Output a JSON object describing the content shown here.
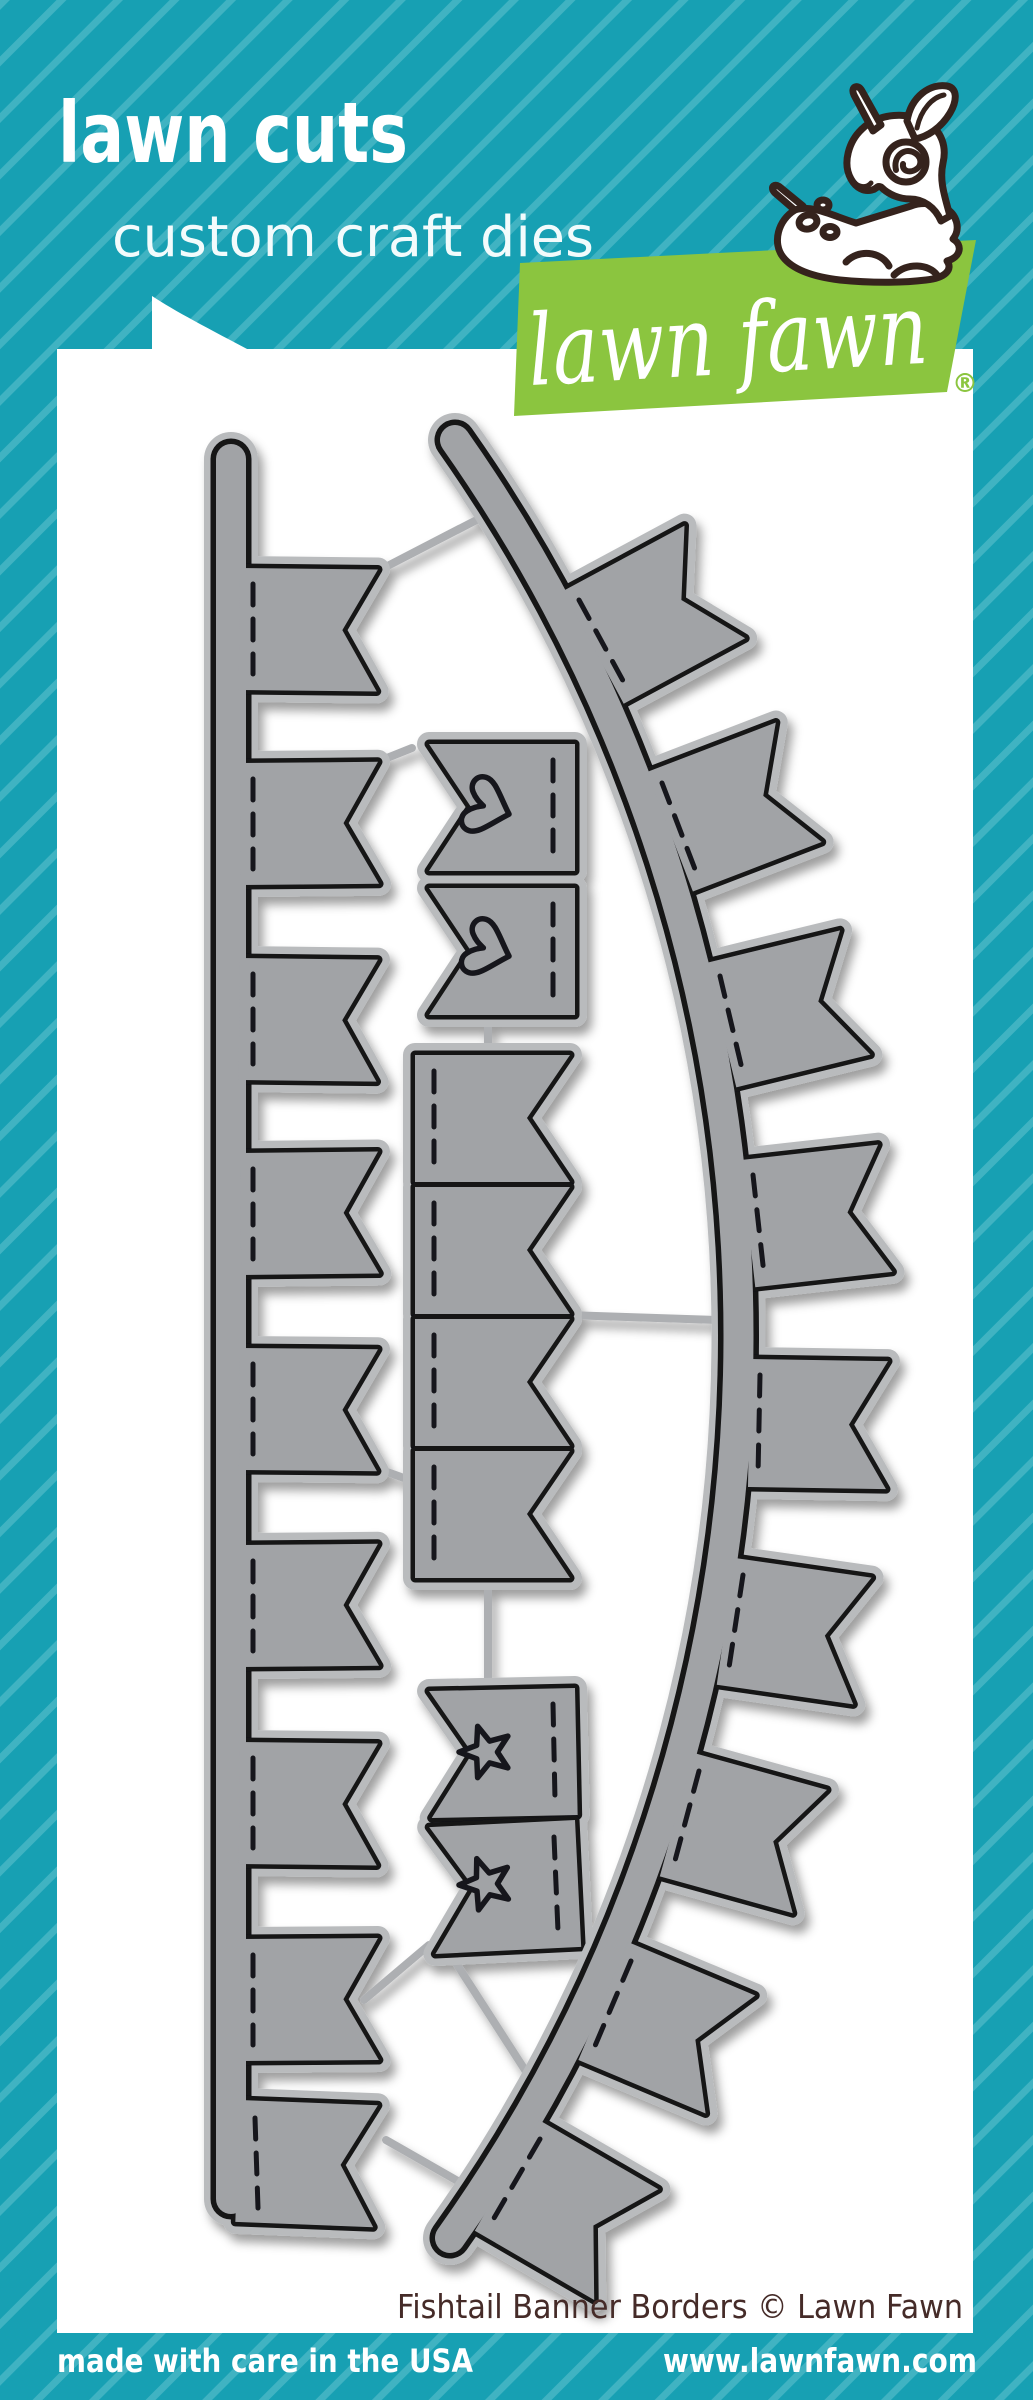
{
  "package": {
    "product_line": "lawn cuts",
    "product_type": "custom craft dies",
    "brand_script": "lawn fawn",
    "registered_mark": "®",
    "caption": "Fishtail Banner Borders © Lawn Fawn",
    "made_in": "made with care in the USA",
    "website": "www.lawnfawn.com"
  },
  "die_set": {
    "description": "Gray metal craft dies on a white backing card",
    "pieces": [
      {
        "name": "straight banner border die",
        "flags": 9,
        "style": "vertical rail with fishtail pennants and stitch lines"
      },
      {
        "name": "mini heart flag die",
        "count": 2,
        "icon": "heart-icon"
      },
      {
        "name": "mini banner flag die",
        "count": 4,
        "icon": "fishtail-flag-icon"
      },
      {
        "name": "mini star flag die",
        "count": 2,
        "icon": "star-icon"
      },
      {
        "name": "curved banner border die",
        "flags": 9,
        "style": "arched rail with fishtail pennants and stitch lines"
      }
    ]
  },
  "colors": {
    "teal_background": "#17a0b3",
    "teal_stripe": "#40b3c2",
    "logo_green": "#8bc53f",
    "backing_card_white": "#ffffff",
    "die_gray": "#a1a3a6",
    "die_rim_gray": "#b9bbbd",
    "die_cut_line": "#121214",
    "caption_brown": "#452b28",
    "deer_outline_brown": "#35231d"
  }
}
